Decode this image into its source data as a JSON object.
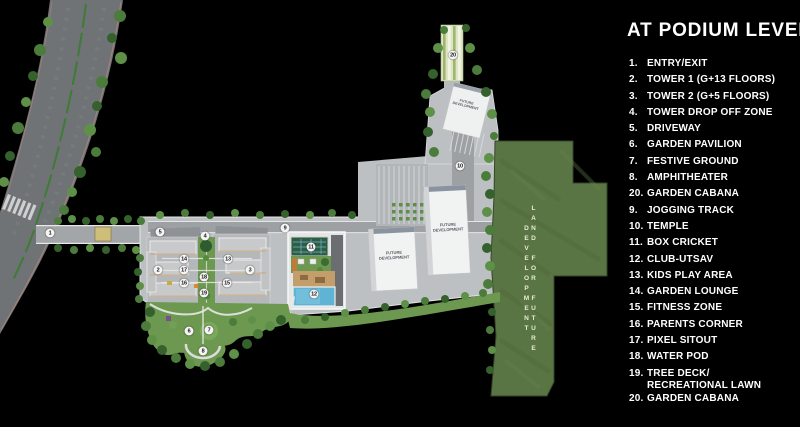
{
  "legend": {
    "title": "AT PODIUM LEVEL",
    "items": [
      {
        "num": "1.",
        "label": "ENTRY/EXIT"
      },
      {
        "num": "2.",
        "label": "TOWER 1 (G+13 FLOORS)"
      },
      {
        "num": "3.",
        "label": "TOWER 2 (G+5 FLOORS)"
      },
      {
        "num": "4.",
        "label": "TOWER DROP OFF ZONE"
      },
      {
        "num": "5.",
        "label": "DRIVEWAY"
      },
      {
        "num": "6.",
        "label": "GARDEN PAVILION"
      },
      {
        "num": "7.",
        "label": "FESTIVE GROUND"
      },
      {
        "num": "8.",
        "label": "AMPHITHEATER"
      },
      {
        "num": "20.",
        "label": "GARDEN CABANA"
      },
      {
        "num": "9.",
        "label": "JOGGING TRACK"
      },
      {
        "num": "10.",
        "label": "TEMPLE"
      },
      {
        "num": "11.",
        "label": "BOX CRICKET"
      },
      {
        "num": "12.",
        "label": "CLUB-UTSAV"
      },
      {
        "num": "13.",
        "label": "KIDS PLAY AREA"
      },
      {
        "num": "14.",
        "label": "GARDEN LOUNGE"
      },
      {
        "num": "15.",
        "label": "FITNESS ZONE"
      },
      {
        "num": "16.",
        "label": "PARENTS CORNER"
      },
      {
        "num": "17.",
        "label": "PIXEL SITOUT"
      },
      {
        "num": "18.",
        "label": "WATER POD"
      },
      {
        "num": "19.",
        "label": "TREE DECK/",
        "label2": "RECREATIONAL LAWN"
      },
      {
        "num": "20.",
        "label": "GARDEN CABANA"
      }
    ]
  },
  "map": {
    "land_future_label": "LAND FOR FUTURE DEVELOPMENT",
    "future_dev_label_line1": "FUTURE",
    "future_dev_label_line2": "DEVELOPMENT",
    "markers": [
      {
        "n": "1"
      },
      {
        "n": "2"
      },
      {
        "n": "3"
      },
      {
        "n": "4"
      },
      {
        "n": "5"
      },
      {
        "n": "6"
      },
      {
        "n": "7"
      },
      {
        "n": "8"
      },
      {
        "n": "9"
      },
      {
        "n": "10"
      },
      {
        "n": "11"
      },
      {
        "n": "12"
      },
      {
        "n": "13"
      },
      {
        "n": "14"
      },
      {
        "n": "15"
      },
      {
        "n": "16"
      },
      {
        "n": "17"
      },
      {
        "n": "18"
      },
      {
        "n": "19"
      },
      {
        "n": "20"
      }
    ],
    "colors": {
      "background": "#000000",
      "road": "#6f7376",
      "podium": "#bdc0c2",
      "land_future": "#5a7544",
      "pool": "#5fb3d4",
      "court": "#2c5e41",
      "tree": "#4c7c3b",
      "legend_text": "#ffffff"
    }
  }
}
